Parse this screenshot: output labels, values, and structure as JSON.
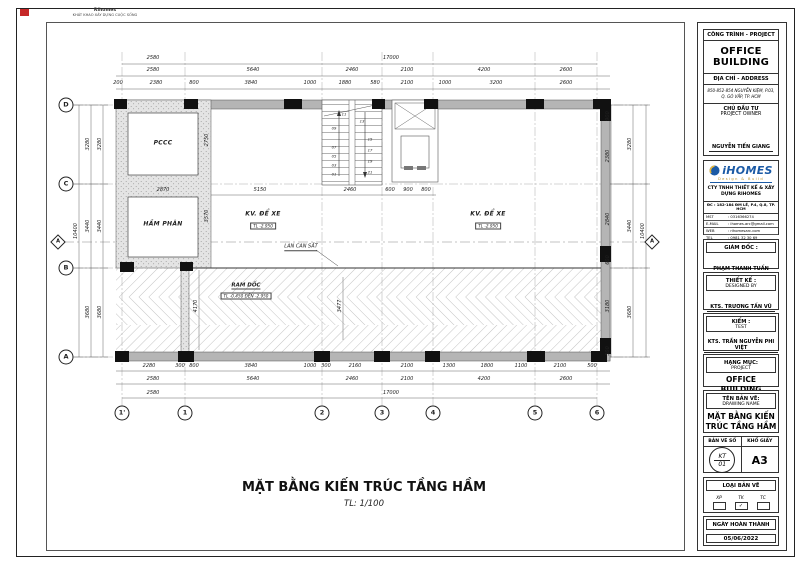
{
  "brand": {
    "name": "Rihomes",
    "slogan": "KHÁT KHAO XÂY DỰNG CUỘC SỐNG"
  },
  "drawing_title": {
    "text": "MẶT BẰNG KIẾN TRÚC TẦNG HẦM",
    "scale": "TL: 1/100"
  },
  "titleblock": {
    "project_header": "CÔNG TRÌNH - PROJECT",
    "project_name": "OFFICE BUILDING",
    "address_header": "ĐỊA CHỈ - ADDRESS",
    "address": "850-852-854 NGUYỄN KIỆM, P.03, Q. GÒ VẤP, TP. HCM",
    "owner_header": "CHỦ ĐẦU TƯ",
    "owner_header_en": "PROJECT OWNER",
    "owner_name": "NGUYỄN TIẾN GIANG",
    "company_logo": "iHOMES",
    "company_logo_sub": "Design & Build",
    "company_name": "CTY TNHH THIẾT KẾ & XÂY DỰNG RIHOMES",
    "company_address": "ĐC : 182-184 ĐM LẼ, P.4, Q.8, TP. HCM",
    "company_rows": [
      {
        "k": "MST",
        "v": ": 0316366274"
      },
      {
        "k": "E-MAIL",
        "v": ": ihomes.arc@gmail.com"
      },
      {
        "k": "WEB",
        "v": ": rihomesarc.com"
      },
      {
        "k": "TEL",
        "v": ": 0981 32 30 69"
      }
    ],
    "director_header": "GIÁM ĐỐC :",
    "director_name": "PHẠM THANH TUẤN",
    "designer_header": "THIẾT KẾ :",
    "designer_header_en": "DESIGNED BY",
    "designer_name": "KTS. TRƯƠNG TẤN VŨ",
    "checker_header": "KIỂM :",
    "checker_header_en": "TEST",
    "checker_name": "KTS. TRẦN NGUYỄN PHI VIỆT",
    "category_header": "HẠNG MỤC:",
    "category_header_en": "PROJECT",
    "category_name": "OFFICE BUILDING",
    "drawing_header": "TÊN BẢN VẼ:",
    "drawing_header_en": "DRAWING NAME",
    "drawing_name": "MẶT BẰNG KIẾN TRÚC TẦNG HẦM",
    "number_header": "BẢN VẼ SỐ",
    "paper_header": "KHỔ GIẤY",
    "number_top": "KT",
    "number_bottom": "01",
    "paper_size": "A3",
    "type_header": "LOẠI BẢN VẼ",
    "type_options": [
      {
        "label": "XP",
        "checked": false
      },
      {
        "label": "TK",
        "checked": true
      },
      {
        "label": "TC",
        "checked": false
      }
    ],
    "date_header": "NGÀY HOÀN THÀNH",
    "date_value": "05/06/2022",
    "accent_blue": "#1b5aa5",
    "accent_gold": "#b8912a"
  },
  "plan": {
    "section_label": "A",
    "grid_cols": [
      [
        "1'",
        122
      ],
      [
        "1",
        185
      ],
      [
        "2",
        322
      ],
      [
        "3",
        382
      ],
      [
        "4",
        433
      ],
      [
        "5",
        535
      ],
      [
        "6",
        597
      ]
    ],
    "grid_rows": [
      [
        "D",
        105
      ],
      [
        "C",
        184
      ],
      [
        "B",
        268
      ],
      [
        "A",
        357
      ]
    ],
    "dims_h": [
      [
        "2580",
        153,
        58
      ],
      [
        "17000",
        391,
        58
      ],
      [
        "2580",
        153,
        70
      ],
      [
        "5640",
        253,
        70
      ],
      [
        "2460",
        352,
        70
      ],
      [
        "2100",
        407,
        70
      ],
      [
        "4200",
        484,
        70
      ],
      [
        "2600",
        566,
        70
      ],
      [
        "200",
        118,
        83
      ],
      [
        "2380",
        156,
        83
      ],
      [
        "800",
        194,
        83
      ],
      [
        "3840",
        251,
        83
      ],
      [
        "1000",
        310,
        83
      ],
      [
        "1880",
        345,
        83
      ],
      [
        "580",
        375,
        83
      ],
      [
        "2100",
        407,
        83
      ],
      [
        "1000",
        445,
        83
      ],
      [
        "3200",
        496,
        83
      ],
      [
        "2600",
        566,
        83
      ],
      [
        "2870",
        163,
        190
      ],
      [
        "5150",
        260,
        190
      ],
      [
        "2460",
        350,
        190
      ],
      [
        "600",
        390,
        190
      ],
      [
        "900",
        408,
        190
      ],
      [
        "800",
        426,
        190
      ],
      [
        "2280",
        149,
        366
      ],
      [
        "300",
        180,
        366
      ],
      [
        "800",
        194,
        366
      ],
      [
        "3840",
        251,
        366
      ],
      [
        "1000",
        310,
        366
      ],
      [
        "300",
        326,
        366
      ],
      [
        "2160",
        355,
        366
      ],
      [
        "2100",
        407,
        366
      ],
      [
        "1300",
        449,
        366
      ],
      [
        "1800",
        487,
        366
      ],
      [
        "1100",
        521,
        366
      ],
      [
        "2100",
        560,
        366
      ],
      [
        "500",
        592,
        366
      ],
      [
        "2580",
        153,
        379
      ],
      [
        "5640",
        253,
        379
      ],
      [
        "2460",
        352,
        379
      ],
      [
        "2100",
        407,
        379
      ],
      [
        "4200",
        484,
        379
      ],
      [
        "2600",
        566,
        379
      ],
      [
        "2580",
        153,
        393
      ],
      [
        "17000",
        391,
        393
      ]
    ],
    "dims_v": [
      [
        "3280",
        88,
        144
      ],
      [
        "3440",
        88,
        226
      ],
      [
        "3680",
        88,
        312
      ],
      [
        "3280",
        100,
        144
      ],
      [
        "3440",
        100,
        226
      ],
      [
        "3680",
        100,
        312
      ],
      [
        "10400",
        76,
        231
      ],
      [
        "2750",
        207,
        140
      ],
      [
        "3570",
        207,
        216
      ],
      [
        "4170",
        196,
        306
      ],
      [
        "3477",
        340,
        306
      ],
      [
        "900",
        608,
        116
      ],
      [
        "2380",
        608,
        156
      ],
      [
        "2840",
        608,
        219
      ],
      [
        "600",
        608,
        260
      ],
      [
        "3180",
        608,
        306
      ],
      [
        "500",
        608,
        351
      ],
      [
        "3280",
        630,
        144
      ],
      [
        "3440",
        630,
        226
      ],
      [
        "3680",
        630,
        312
      ],
      [
        "10400",
        643,
        231
      ]
    ],
    "labels": [
      {
        "t": "PCCC",
        "x": 163,
        "y": 143,
        "c": "room"
      },
      {
        "t": "HẦM PHÂN",
        "x": 163,
        "y": 224,
        "c": "room"
      },
      {
        "t": "KV. ĐỂ XE",
        "x": 263,
        "y": 214,
        "c": "room"
      },
      {
        "t": "TL -2.950",
        "x": 263,
        "y": 226,
        "c": "lvl"
      },
      {
        "t": "KV. ĐỂ XE",
        "x": 488,
        "y": 214,
        "c": "room"
      },
      {
        "t": "TL -2.950",
        "x": 488,
        "y": 226,
        "c": "lvl"
      },
      {
        "t": "LAN CAN SẮT",
        "x": 301,
        "y": 247,
        "c": "ann"
      },
      {
        "t": "RAM DỐC",
        "x": 246,
        "y": 286,
        "c": "ramp"
      },
      {
        "t": "TL -0.450 ĐẾN -2.950",
        "x": 246,
        "y": 296,
        "c": "lvl"
      }
    ],
    "stair_numbers": [
      [
        "01",
        334,
        174
      ],
      [
        "03",
        334,
        165
      ],
      [
        "05",
        334,
        156
      ],
      [
        "07",
        334,
        147
      ],
      [
        "09",
        334,
        128
      ],
      [
        "11",
        344,
        114
      ],
      [
        "13",
        362,
        121
      ],
      [
        "15",
        370,
        139
      ],
      [
        "17",
        370,
        150
      ],
      [
        "19",
        370,
        161
      ],
      [
        "21",
        370,
        172
      ]
    ]
  }
}
